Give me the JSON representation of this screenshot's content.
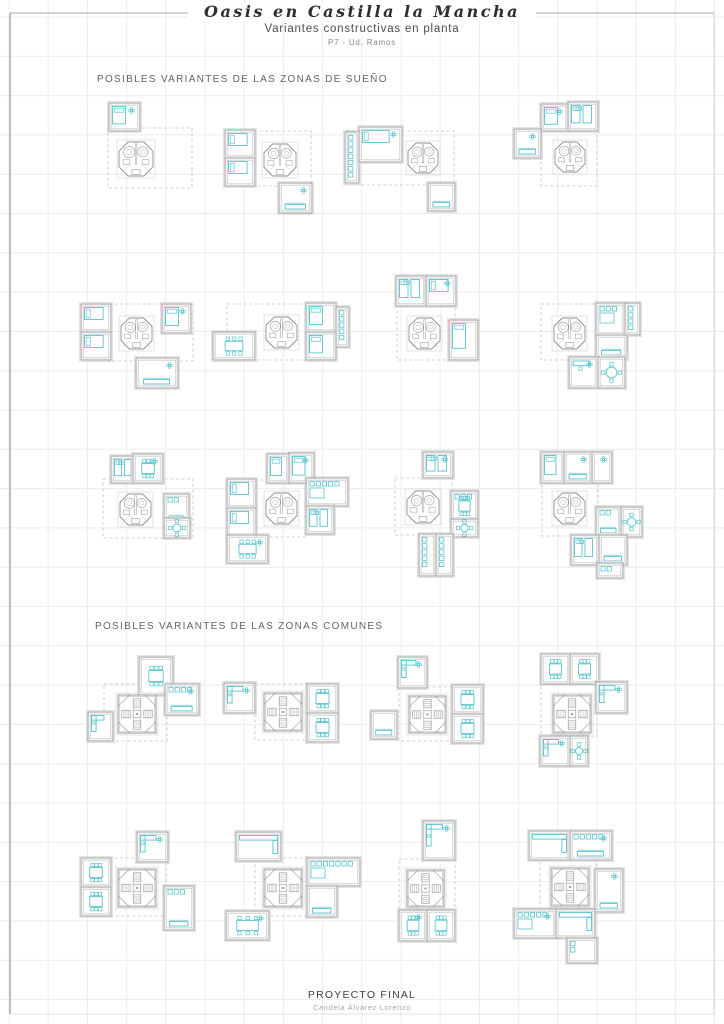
{
  "page": {
    "title": "Oasis en Castilla la Mancha",
    "subtitle": "Variantes constructivas en planta",
    "sheet_label": "P7 - Ud. Ramos",
    "footer_title": "PROYECTO FINAL",
    "footer_author": "Candela Álvarez Lorenzo"
  },
  "sections": [
    {
      "id": "suenyo",
      "heading": "POSIBLES VARIANTES DE LAS ZONAS DE SUEÑO"
    },
    {
      "id": "comunes",
      "heading": "POSIBLES VARIANTES DE LAS ZONAS COMUNES"
    }
  ],
  "colors": {
    "accent_cyan": "#58c4cf",
    "wall_gray": "#9a9a9a",
    "detail_gray": "#a8a8a8",
    "halo_gray": "#dcdcdc",
    "dash_gray": "#c2c2c2",
    "grid_line": "#ebecef",
    "border_gray": "#a6a6a6"
  },
  "grid": {
    "spacing_x": 39.2,
    "spacing_y": 39.3,
    "offset_x": 9,
    "offset_y": 17
  },
  "border": {
    "top_y": 13,
    "left_x": 10,
    "right_x": 714,
    "bottom_y": 1014,
    "title_gap": [
      205,
      470
    ]
  },
  "plans": {
    "core_legend": {
      "bath": "octagonal bathroom core (zonas de sueño)",
      "stairs": "octagonal stair core (zonas comunes)"
    },
    "clusters": [
      {
        "id": "sueno-1",
        "section": "suenyo",
        "core": [
          "bath",
          119,
          142,
          34
        ],
        "dash": [
          108,
          128,
          84,
          60
        ],
        "rooms": [
          [
            109,
            103,
            31,
            28,
            "bed-v flower"
          ]
        ]
      },
      {
        "id": "sueno-2",
        "section": "suenyo",
        "core": [
          "bath",
          264,
          144,
          32
        ],
        "dash": [
          226,
          131,
          85,
          55
        ],
        "rooms": [
          [
            225,
            130,
            30,
            28,
            "bed-h"
          ],
          [
            225,
            158,
            30,
            28,
            "bed-h"
          ],
          [
            279,
            183,
            33,
            30,
            "sofa flower"
          ]
        ]
      },
      {
        "id": "sueno-3",
        "section": "suenyo",
        "core": [
          "bath",
          408,
          143,
          30
        ],
        "dash": [
          346,
          131,
          108,
          54
        ],
        "rooms": [
          [
            345,
            132,
            14,
            51,
            "closet"
          ],
          [
            359,
            127,
            43,
            35,
            "bed-h flower"
          ],
          [
            428,
            183,
            27,
            28,
            "sofa"
          ]
        ]
      },
      {
        "id": "sueno-4",
        "section": "suenyo",
        "core": [
          "bath",
          555,
          142,
          30
        ],
        "dash": [
          541,
          129,
          56,
          57
        ],
        "rooms": [
          [
            541,
            104,
            27,
            27,
            "bed-v flower"
          ],
          [
            568,
            102,
            30,
            29,
            "beds-2"
          ],
          [
            514,
            129,
            27,
            29,
            "sofa flower"
          ]
        ]
      },
      {
        "id": "sueno-5",
        "section": "suenyo",
        "core": [
          "bath",
          121,
          318,
          31
        ],
        "dash": [
          109,
          304,
          84,
          57
        ],
        "rooms": [
          [
            81,
            304,
            30,
            28,
            "bed-h"
          ],
          [
            81,
            332,
            30,
            28,
            "bed-h"
          ],
          [
            162,
            304,
            29,
            29,
            "bed-v flower"
          ],
          [
            136,
            358,
            42,
            30,
            "sofa flower"
          ]
        ]
      },
      {
        "id": "sueno-6",
        "section": "suenyo",
        "core": [
          "bath",
          266,
          317,
          31
        ],
        "dash": [
          227,
          304,
          81,
          56
        ],
        "rooms": [
          [
            213,
            332,
            42,
            28,
            "dining"
          ],
          [
            306,
            303,
            30,
            29,
            "bed-v"
          ],
          [
            306,
            332,
            30,
            28,
            "bed-v"
          ],
          [
            336,
            307,
            13,
            40,
            "closet"
          ]
        ]
      },
      {
        "id": "sueno-7",
        "section": "suenyo",
        "core": [
          "bath",
          409,
          318,
          31
        ],
        "dash": [
          397,
          304,
          58,
          56
        ],
        "rooms": [
          [
            396,
            276,
            30,
            30,
            "beds-2"
          ],
          [
            426,
            276,
            30,
            30,
            "bed-h flower"
          ],
          [
            449,
            320,
            29,
            40,
            "bed-v"
          ]
        ]
      },
      {
        "id": "sueno-8",
        "section": "suenyo",
        "core": [
          "bath",
          554,
          318,
          31
        ],
        "dash": [
          541,
          304,
          56,
          56
        ],
        "rooms": [
          [
            596,
            303,
            29,
            32,
            "wardrobe"
          ],
          [
            625,
            303,
            15,
            32,
            "closet"
          ],
          [
            596,
            335,
            31,
            24,
            "sofa"
          ],
          [
            569,
            357,
            29,
            31,
            "desk flower"
          ],
          [
            598,
            357,
            27,
            31,
            "round"
          ]
        ]
      },
      {
        "id": "sueno-9",
        "section": "suenyo",
        "core": [
          "bath",
          120,
          494,
          31
        ],
        "dash": [
          103,
          479,
          90,
          59
        ],
        "rooms": [
          [
            111,
            456,
            22,
            27,
            "beds-2"
          ],
          [
            133,
            454,
            30,
            29,
            "dining flower"
          ],
          [
            164,
            494,
            25,
            31,
            "sofa closet-top"
          ],
          [
            164,
            518,
            26,
            20,
            "round"
          ]
        ]
      },
      {
        "id": "sueno-10",
        "section": "suenyo",
        "core": [
          "bath",
          266,
          493,
          31
        ],
        "dash": [
          227,
          480,
          81,
          57
        ],
        "rooms": [
          [
            267,
            454,
            22,
            29,
            "bed-v"
          ],
          [
            289,
            453,
            25,
            30,
            "bed-v flower"
          ],
          [
            227,
            479,
            29,
            29,
            "bed-h"
          ],
          [
            227,
            508,
            29,
            29,
            "bed-h"
          ],
          [
            227,
            535,
            41,
            28,
            "dining flower"
          ],
          [
            306,
            478,
            42,
            28,
            "wardrobe-wide"
          ],
          [
            306,
            506,
            28,
            28,
            "beds-2"
          ]
        ]
      },
      {
        "id": "sueno-11",
        "section": "suenyo",
        "core": [
          "bath",
          407,
          491,
          32
        ],
        "dash": [
          395,
          478,
          57,
          57
        ],
        "rooms": [
          [
            423,
            452,
            30,
            26,
            "beds-2 flower"
          ],
          [
            451,
            491,
            27,
            30,
            "dining closet-top"
          ],
          [
            451,
            519,
            27,
            18,
            "round"
          ],
          [
            419,
            534,
            17,
            42,
            "closet"
          ],
          [
            436,
            534,
            17,
            42,
            "closet"
          ]
        ]
      },
      {
        "id": "sueno-12",
        "section": "suenyo",
        "core": [
          "bath",
          554,
          493,
          31
        ],
        "dash": [
          542,
          478,
          56,
          58
        ],
        "rooms": [
          [
            541,
            452,
            23,
            31,
            "bed-v"
          ],
          [
            564,
            452,
            28,
            31,
            "sofa flower"
          ],
          [
            592,
            452,
            20,
            31,
            "flower"
          ],
          [
            596,
            507,
            25,
            30,
            "sofa closet-top"
          ],
          [
            621,
            507,
            21,
            30,
            "round"
          ],
          [
            571,
            535,
            28,
            30,
            "beds-2"
          ],
          [
            599,
            535,
            28,
            30,
            "sofa"
          ],
          [
            597,
            563,
            26,
            15,
            "wardrobe-row"
          ]
        ]
      },
      {
        "id": "comunes-1",
        "section": "comunes",
        "core": [
          "stairs",
          118,
          695,
          38
        ],
        "dash": [
          104,
          684,
          63,
          57
        ],
        "rooms": [
          [
            139,
            657,
            34,
            38,
            "dining"
          ],
          [
            165,
            684,
            34,
            31,
            "sofa closet-top flower"
          ],
          [
            88,
            712,
            25,
            29,
            "kitchen"
          ]
        ]
      },
      {
        "id": "comunes-2",
        "section": "comunes",
        "core": [
          "stairs",
          264,
          693,
          38
        ],
        "dash": [
          255,
          684,
          53,
          56
        ],
        "rooms": [
          [
            224,
            683,
            31,
            30,
            "kitchen flower"
          ],
          [
            307,
            684,
            31,
            29,
            "dining"
          ],
          [
            307,
            713,
            31,
            29,
            "dining"
          ]
        ]
      },
      {
        "id": "comunes-3",
        "section": "comunes",
        "core": [
          "stairs",
          409,
          696,
          37
        ],
        "dash": [
          399,
          687,
          54,
          54
        ],
        "rooms": [
          [
            398,
            657,
            29,
            31,
            "kitchen flower"
          ],
          [
            452,
            685,
            31,
            29,
            "dining"
          ],
          [
            452,
            714,
            31,
            29,
            "dining"
          ],
          [
            371,
            711,
            26,
            28,
            "sofa"
          ]
        ]
      },
      {
        "id": "comunes-4",
        "section": "comunes",
        "core": [
          "stairs",
          553,
          695,
          38
        ],
        "dash": [
          541,
          684,
          56,
          53
        ],
        "rooms": [
          [
            541,
            654,
            29,
            30,
            "dining"
          ],
          [
            570,
            654,
            29,
            30,
            "dining"
          ],
          [
            596,
            682,
            31,
            31,
            "kitchen flower"
          ],
          [
            540,
            736,
            30,
            30,
            "kitchen flower"
          ],
          [
            570,
            736,
            18,
            30,
            "round"
          ]
        ]
      },
      {
        "id": "comunes-5",
        "section": "comunes",
        "core": [
          "stairs",
          118,
          869,
          38
        ],
        "dash": [
          109,
          858,
          57,
          58
        ],
        "rooms": [
          [
            137,
            832,
            31,
            30,
            "kitchen flower"
          ],
          [
            81,
            858,
            30,
            29,
            "dining"
          ],
          [
            81,
            887,
            30,
            29,
            "dining"
          ],
          [
            164,
            886,
            30,
            44,
            "sofa wardrobe-top"
          ]
        ]
      },
      {
        "id": "comunes-6",
        "section": "comunes",
        "core": [
          "stairs",
          264,
          869,
          38
        ],
        "dash": [
          255,
          858,
          53,
          58
        ],
        "rooms": [
          [
            236,
            832,
            45,
            29,
            "kitchen-wide"
          ],
          [
            226,
            911,
            43,
            29,
            "dining-wide flower"
          ],
          [
            307,
            858,
            53,
            28,
            "wardrobe-wide"
          ],
          [
            307,
            886,
            30,
            31,
            "sofa"
          ]
        ]
      },
      {
        "id": "comunes-7",
        "section": "comunes",
        "core": [
          "stairs",
          407,
          870,
          37
        ],
        "dash": [
          399,
          859,
          56,
          53
        ],
        "rooms": [
          [
            423,
            821,
            32,
            39,
            "kitchen flower"
          ],
          [
            399,
            910,
            28,
            31,
            "dining flower"
          ],
          [
            427,
            910,
            28,
            31,
            "dining"
          ]
        ]
      },
      {
        "id": "comunes-8",
        "section": "comunes",
        "core": [
          "stairs",
          551,
          868,
          38
        ],
        "dash": [
          540,
          858,
          56,
          51
        ],
        "rooms": [
          [
            529,
            831,
            41,
            29,
            "kitchen-wide"
          ],
          [
            570,
            831,
            42,
            29,
            "sofa closet-top flower"
          ],
          [
            595,
            869,
            28,
            43,
            "sofa flower"
          ],
          [
            514,
            909,
            42,
            29,
            "wardrobe-wide flower"
          ],
          [
            556,
            909,
            39,
            29,
            "counter-L"
          ],
          [
            567,
            938,
            30,
            25,
            "closet"
          ]
        ]
      }
    ]
  }
}
